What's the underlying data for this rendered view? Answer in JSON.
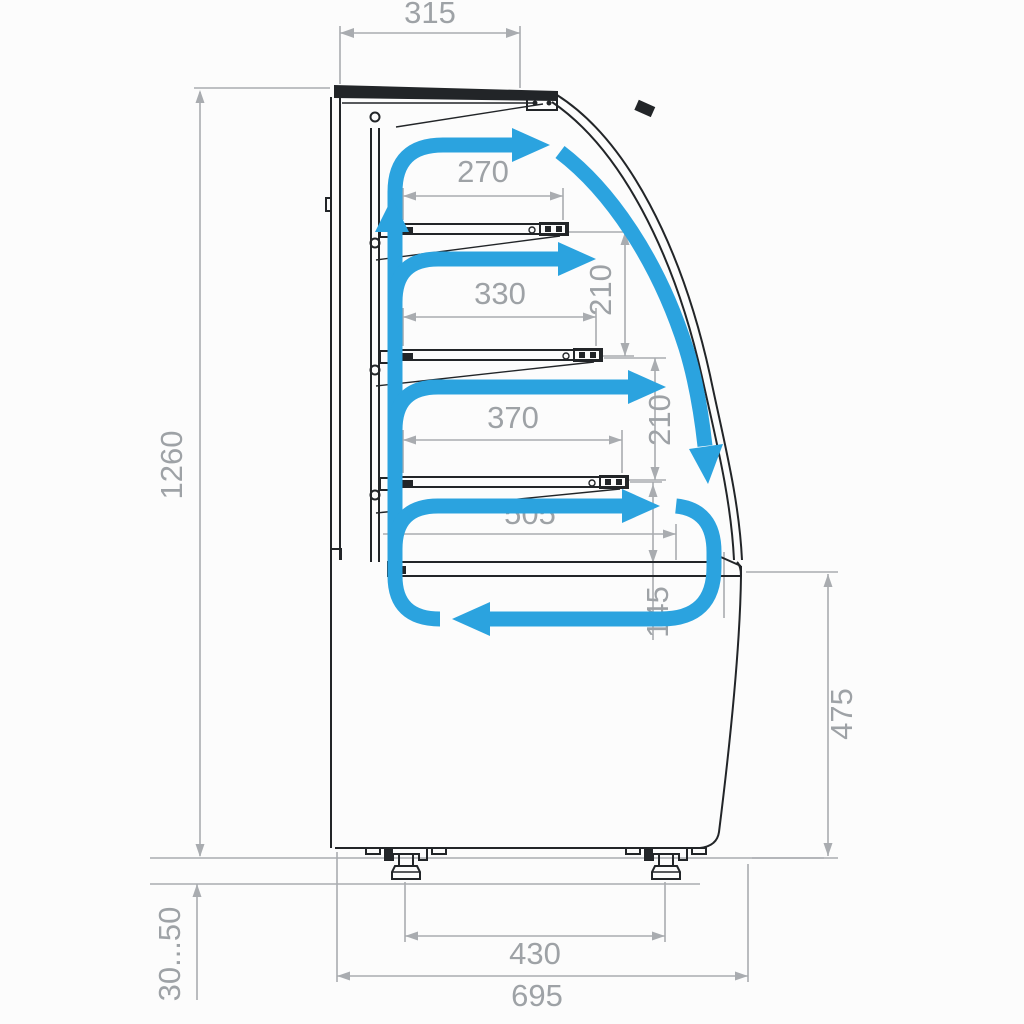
{
  "title": "Refrigerated pastry display case — side section with air circulation",
  "dims": {
    "top_width": "315",
    "total_height": "1260",
    "shelf_1_depth": "270",
    "shelf_2_depth": "330",
    "shelf_3_depth": "370",
    "bottom_deck_depth": "505",
    "shelf_gap_1": "210",
    "shelf_gap_2": "210",
    "deck_gap": "145",
    "front_panel_height": "475",
    "foot_adjust_range": "30...50",
    "feet_spacing": "430",
    "total_depth": "695"
  },
  "colors": {
    "airflow": "#2ba3df",
    "dimension_lines": "#a9acb0",
    "dimension_text": "#9ea2a6",
    "outline": "#222528",
    "background": "#fcfcfc"
  },
  "airflow": {
    "description": "Cold air rises in the rear duct, blows across above each of the three shelves, flows down along the curved front glass and recirculates in a loop around the bottom deck"
  }
}
